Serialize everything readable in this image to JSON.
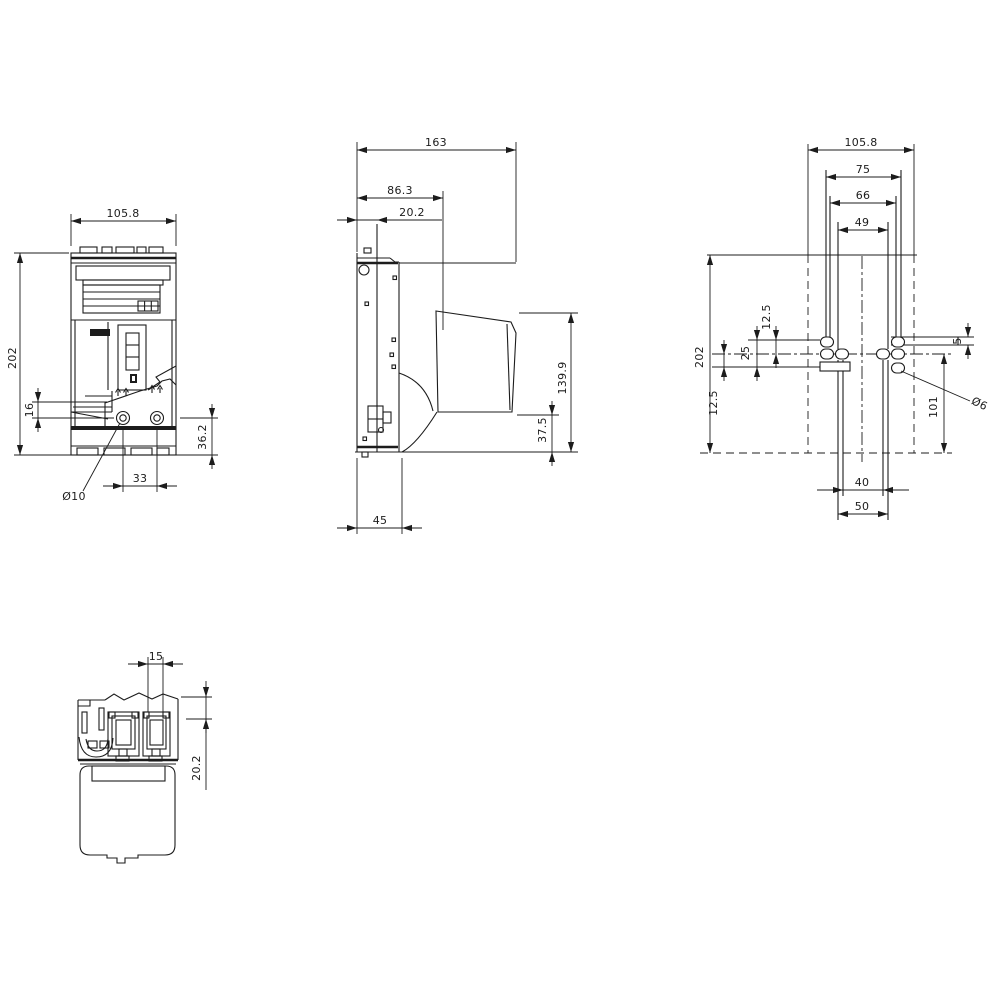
{
  "colors": {
    "line": "#1c1c1c",
    "background": "#ffffff"
  },
  "front": {
    "width": "105.8",
    "height": "202",
    "lug_to_hole": "16",
    "hole_to_bottom": "36.2",
    "hole_spacing": "33",
    "hole_diameter": "Ø10"
  },
  "side": {
    "depth": "163",
    "cover_depth": "86.3",
    "recess_depth": "20.2",
    "handle_height": "139.9",
    "base_height": "37.5",
    "base_depth": "45"
  },
  "drill": {
    "width": "105.8",
    "span_75": "75",
    "span_66": "66",
    "span_49": "49",
    "height": "202",
    "offset_top": "12.5",
    "hole_pitch": "25",
    "offset_bottom": "12.5",
    "center_to_bottom": "101",
    "bar_thickness": "5",
    "slot_inner": "40",
    "slot_outer": "50",
    "hole_diameter": "Ø6"
  },
  "bottom": {
    "slot_width": "15",
    "recess_depth": "20.2"
  }
}
